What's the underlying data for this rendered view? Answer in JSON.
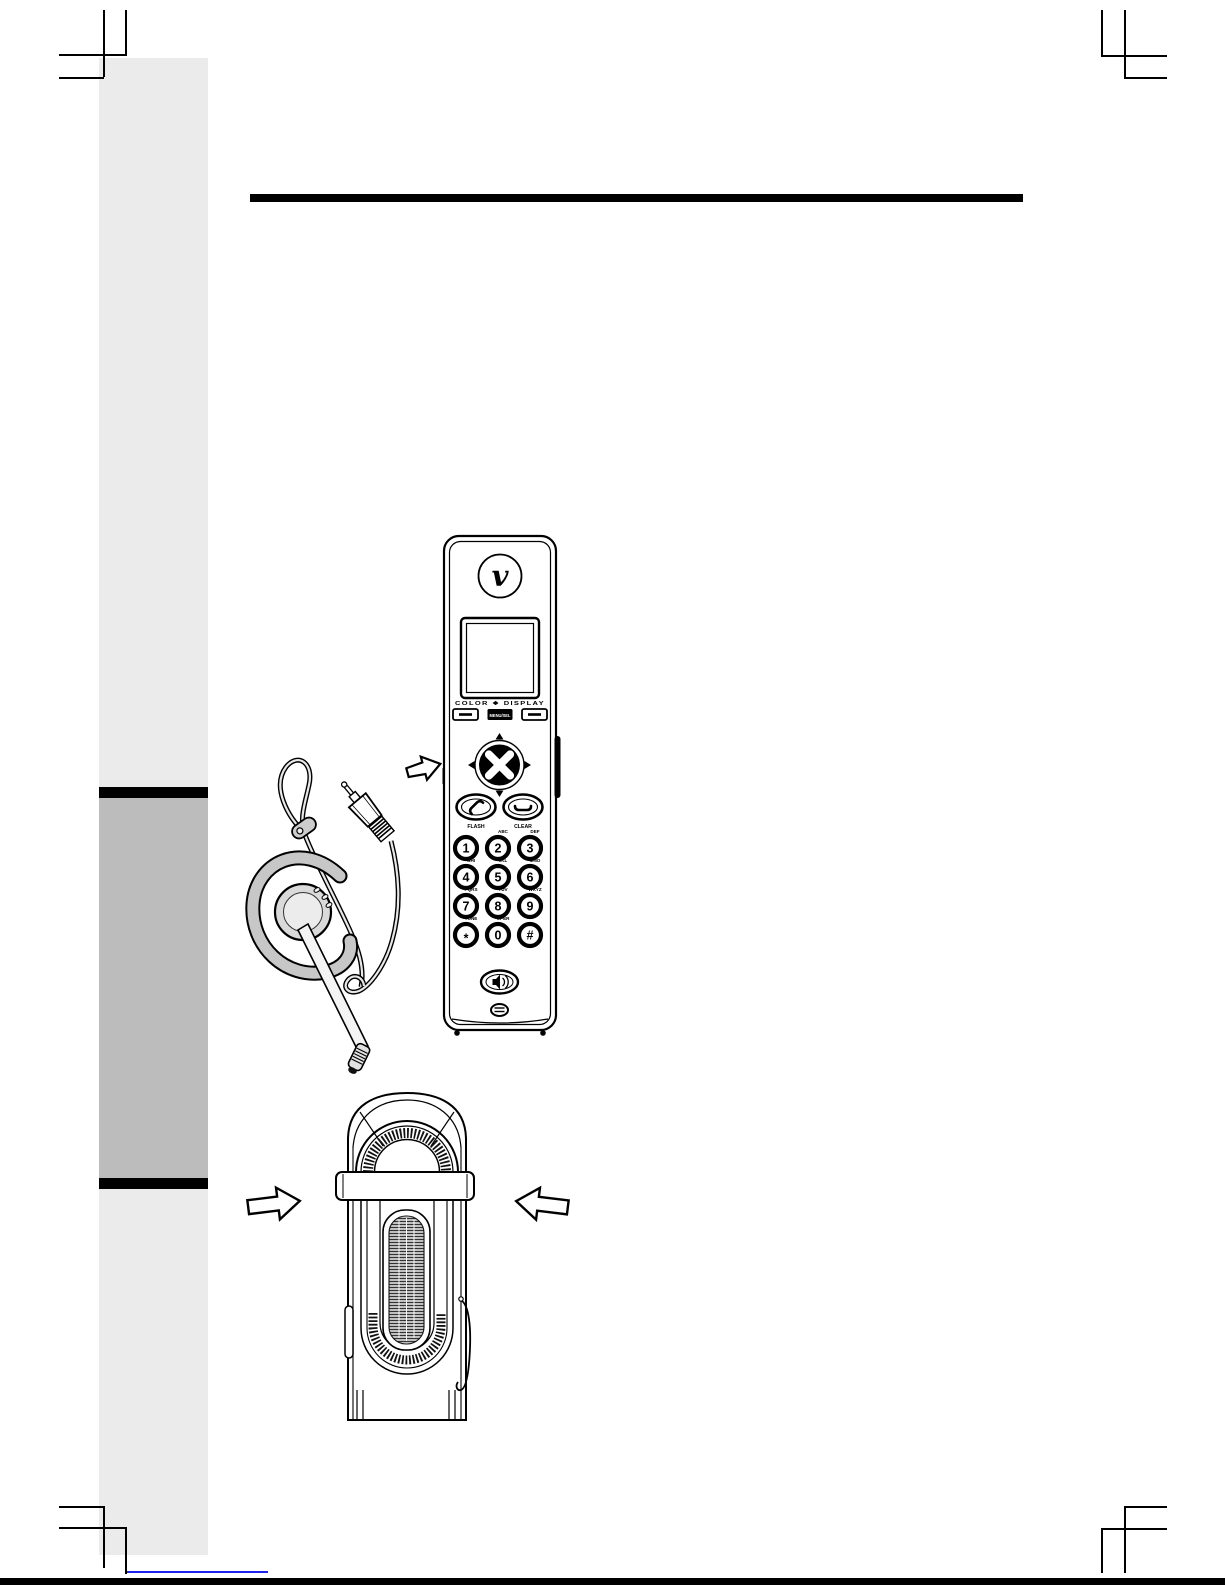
{
  "page": {
    "colors": {
      "sidebar_light": "#ebebeb",
      "sidebar_mid": "#bcbcbc",
      "heading_bar": "#000000",
      "link_blue": "#2121ee"
    }
  },
  "handset": {
    "brand_logo_char": "v",
    "display_caption": "COLOR ❖ DISPLAY",
    "menu_key_label": "MENU/SEL",
    "talk_key_label": "FLASH",
    "end_key_label": "CLEAR",
    "keypad": [
      {
        "digit": "1",
        "letters": ""
      },
      {
        "digit": "2",
        "letters": "ABC"
      },
      {
        "digit": "3",
        "letters": "DEF"
      },
      {
        "digit": "4",
        "letters": "GHI"
      },
      {
        "digit": "5",
        "letters": "JKL"
      },
      {
        "digit": "6",
        "letters": "MNO"
      },
      {
        "digit": "7",
        "letters": "PQRS"
      },
      {
        "digit": "8",
        "letters": "TUV"
      },
      {
        "digit": "9",
        "letters": "WXYZ"
      },
      {
        "digit": "*",
        "letters": "TONE"
      },
      {
        "digit": "0",
        "letters": "OPER"
      },
      {
        "digit": "#",
        "letters": ""
      }
    ]
  },
  "illustrations": {
    "headset_plug_arrow": "block-arrow-right",
    "belt_clip_left_arrow": "block-arrow-right",
    "belt_clip_right_arrow": "block-arrow-left"
  }
}
